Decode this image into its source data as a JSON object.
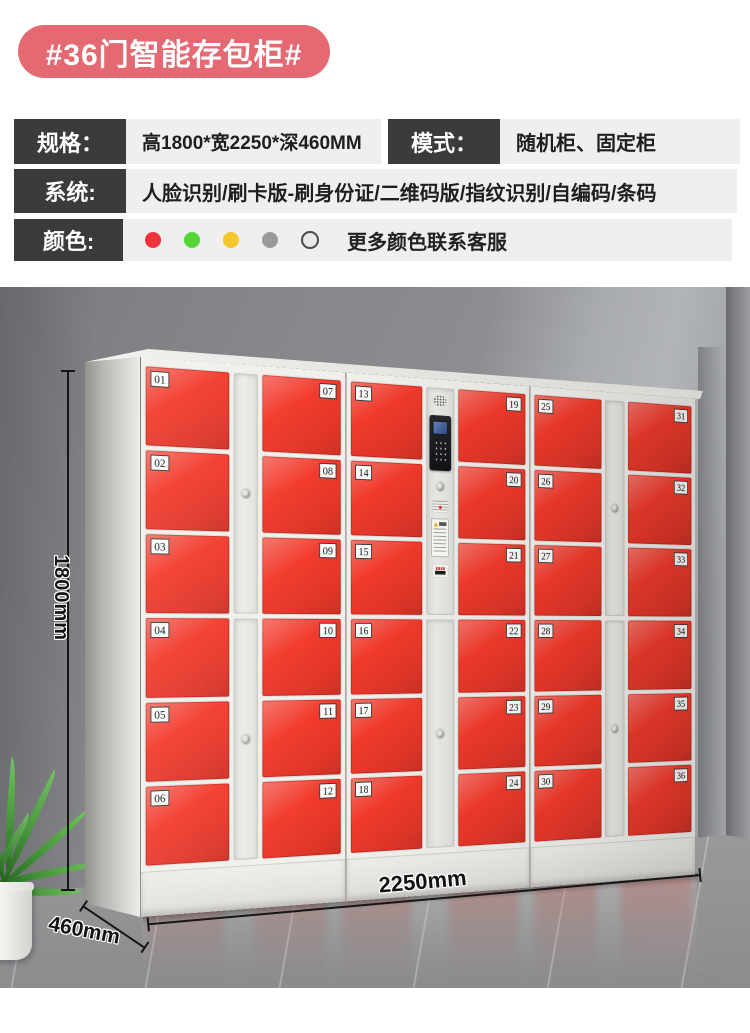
{
  "header": {
    "title": "#36门智能存包柜#",
    "badge_color": "#e46972",
    "spec": {
      "label": "规格：",
      "value": "高1800*宽2250*深460MM"
    },
    "mode": {
      "label": "模式：",
      "value": "随机柜、固定柜"
    },
    "system": {
      "label": "系统:",
      "value": "人脸识别/刷卡版-刷身份证/二维码版/指纹识别/自编码/条码"
    },
    "color": {
      "label": "颜色:",
      "note": "更多颜色联系客服",
      "swatches": [
        {
          "hex": "#f0333c"
        },
        {
          "hex": "#55d437"
        },
        {
          "hex": "#f6c62e"
        },
        {
          "hex": "#9b9b9b"
        },
        {
          "hex": "#e9e9e9",
          "outlined": true,
          "ring": "#4a4a4a"
        }
      ]
    }
  },
  "locker": {
    "door_color": "#f23a2c",
    "frame_color": "#f1f0ec",
    "units": [
      {
        "strip": "lock-strip",
        "left_doors": [
          "01",
          "02",
          "03",
          "04",
          "05",
          "06"
        ],
        "right_doors": [
          "07",
          "08",
          "09",
          "10",
          "11",
          "12"
        ]
      },
      {
        "strip": "control-panel",
        "left_doors": [
          "13",
          "14",
          "15",
          "16",
          "17",
          "18"
        ],
        "right_doors": [
          "19",
          "20",
          "21",
          "22",
          "23",
          "24"
        ]
      },
      {
        "strip": "lock-strip",
        "left_doors": [
          "25",
          "26",
          "27",
          "28",
          "29",
          "30"
        ],
        "right_doors": [
          "31",
          "32",
          "33",
          "34",
          "35",
          "36"
        ]
      }
    ]
  },
  "dimensions": {
    "height": "1800mm",
    "width": "2250mm",
    "depth": "460mm"
  }
}
